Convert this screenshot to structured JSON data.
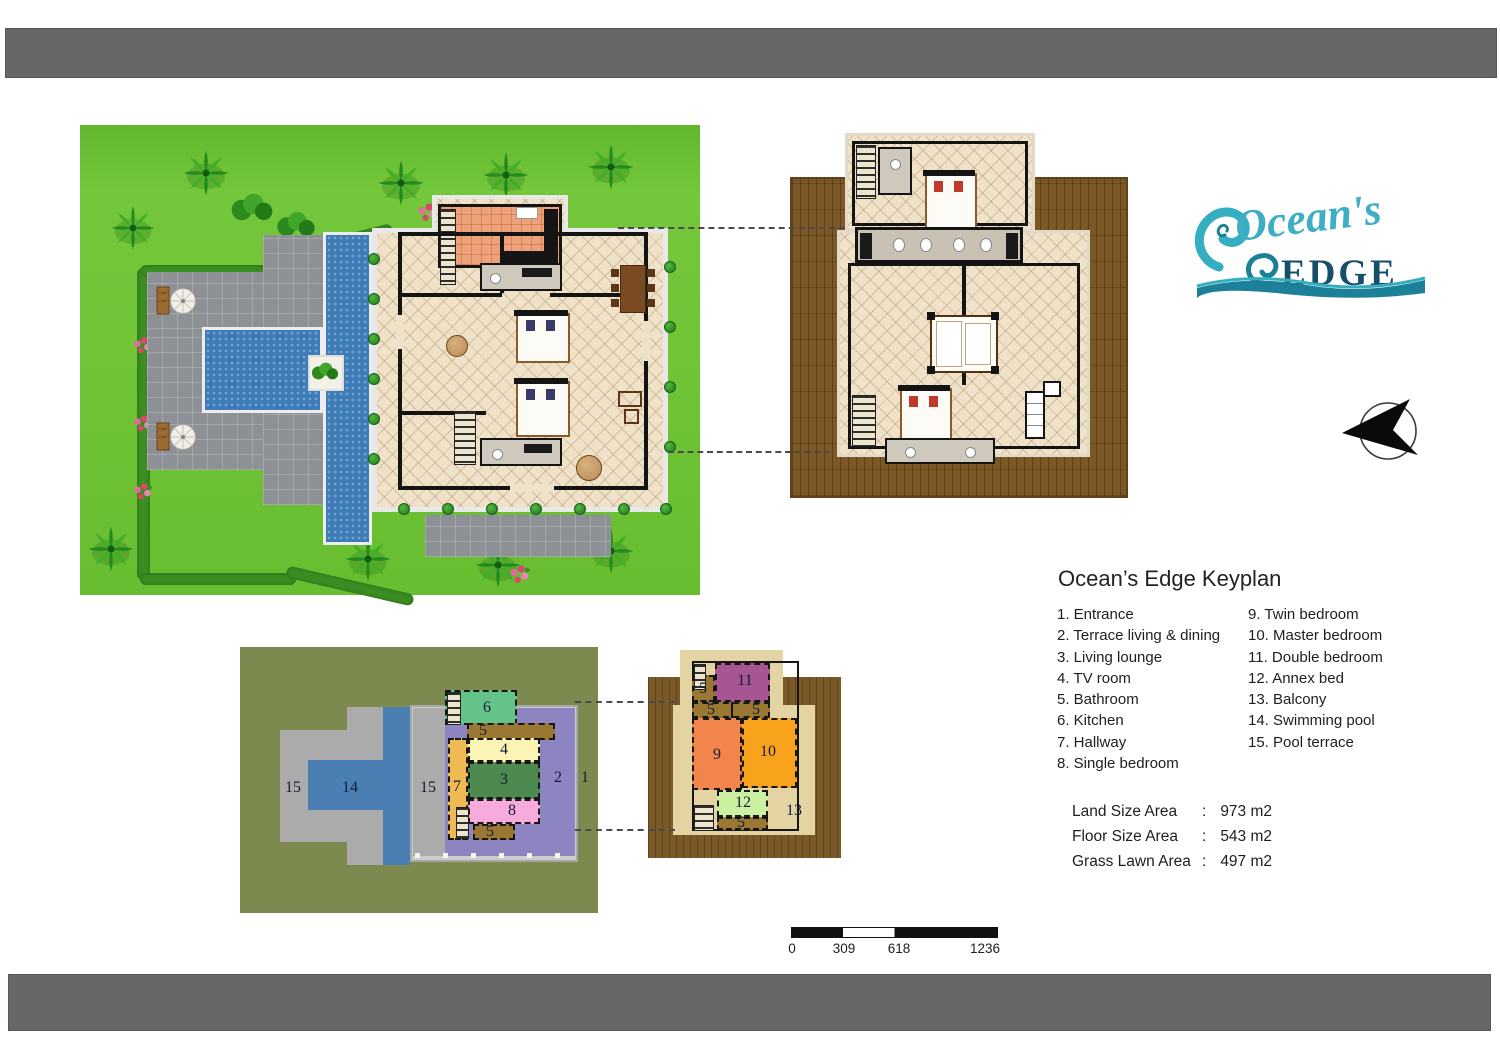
{
  "logo": {
    "script": "Ocean's",
    "word": "EDGE"
  },
  "keyplan": {
    "title": "Ocean’s Edge Keyplan",
    "col1": [
      "1. Entrance",
      "2. Terrace living & dining",
      "3. Living lounge",
      "4. TV room",
      "5. Bathroom",
      "6. Kitchen",
      "7. Hallway",
      "8. Single bedroom"
    ],
    "col2": [
      "9. Twin bedroom",
      "10. Master bedroom",
      "11. Double bedroom",
      "12. Annex bed",
      "13. Balcony",
      "14. Swimming pool",
      "15. Pool terrace"
    ]
  },
  "areas": [
    {
      "label": "Land Size Area",
      "sep": ":",
      "value": "973 m2"
    },
    {
      "label": "Floor Size Area",
      "sep": ":",
      "value": "543 m2"
    },
    {
      "label": "Grass Lawn Area",
      "sep": ":",
      "value": "497 m2"
    }
  ],
  "scale": {
    "labels": [
      "0",
      "309",
      "618",
      "1236"
    ]
  },
  "ks_labels": [
    "15",
    "14",
    "15",
    "7",
    "6",
    "5",
    "4",
    "3",
    "8",
    "5",
    "2",
    "1"
  ],
  "km_labels": [
    "5",
    "11",
    "5",
    "5",
    "9",
    "10",
    "12",
    "5",
    "13"
  ],
  "colors": {
    "lawn": "#6FC335",
    "pool": "#3E7CB8",
    "paving": "#8D9094",
    "deck": "#7B5826",
    "tile": "#F0E2C8",
    "kitchen_tile": "#ECA37B",
    "olive": "#7C8A50",
    "purple": "#8D85C1",
    "teal": "#3FAEC4",
    "navy": "#164F6A",
    "bar_gray": "#696667",
    "room_kitchen": "#63C388",
    "room_tv": "#FAF4B5",
    "room_lounge": "#4C8A50",
    "room_single": "#F7ABDB",
    "room_hall": "#EFB954",
    "room_bath": "#9A7833",
    "room_twin": "#F2854B",
    "room_master": "#F9A21B",
    "room_double": "#A85594",
    "room_annex": "#CBF0A2",
    "balcony_tan": "#E4D4A4"
  }
}
